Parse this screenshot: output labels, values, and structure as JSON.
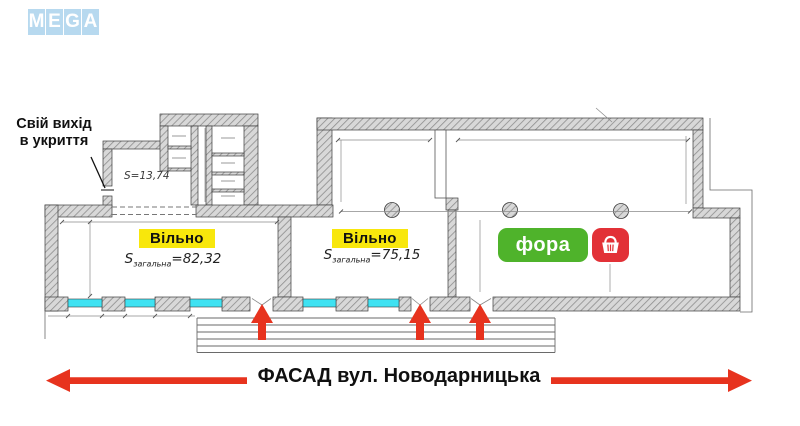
{
  "mega_logo": {
    "letters": [
      "M",
      "E",
      "G",
      "A"
    ],
    "tile_color": "#b7d9ef"
  },
  "shelter_note": {
    "line1": "Свій вихід",
    "line2": "в укриття"
  },
  "plan_labels": {
    "small_room_area": "S=13,74",
    "space1": {
      "status": "Вільно",
      "s": "S",
      "sub": "загальна",
      "value": "=82,32"
    },
    "space2": {
      "status": "Вільно",
      "s": "S",
      "sub": "загальна",
      "value": "=75,15"
    }
  },
  "fora_badge": {
    "name": "фора",
    "basket_icon": "shopping-basket",
    "green": "#4fb32b",
    "red": "#e23137"
  },
  "facade": {
    "title": "ФАСАД вул. Новодарницька",
    "arrow_color": "#e7331e"
  },
  "colors": {
    "wall_fill": "#d8d8d8",
    "wall_hatch": "#8d8d8d",
    "outline": "#3c3c3c",
    "window_highlight": "#3fe2f2",
    "available_highlight": "#f8e70c",
    "entrance_arrow": "#e7331e",
    "mega_blue": "#b7d9ef"
  }
}
